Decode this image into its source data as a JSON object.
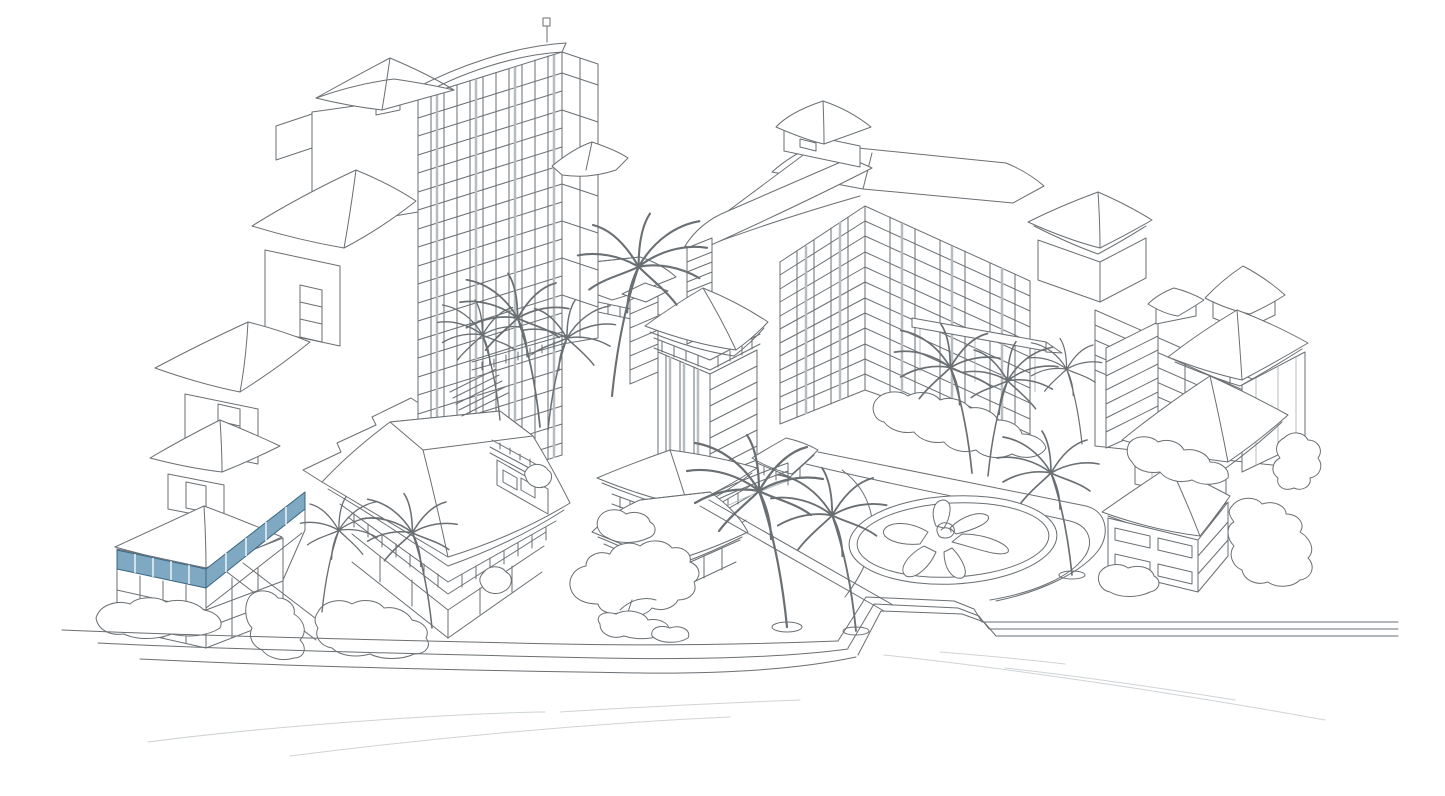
{
  "illustration": {
    "description": "Isometric line-art illustration of a beachfront resort complex with towers, pavilions, palm trees, a flower garden bed and a seawall promenade; one top-floor section of the lower-left beachfront building is highlighted in blue",
    "background_color": "#ffffff",
    "line_color": "#6a6f73",
    "light_line_color": "#b6bcbf",
    "wave_line_color": "#ced3d6",
    "highlight": {
      "fill": "#7fa9c2",
      "stroke": "#3a657f",
      "label": "highlighted-building-section"
    }
  }
}
